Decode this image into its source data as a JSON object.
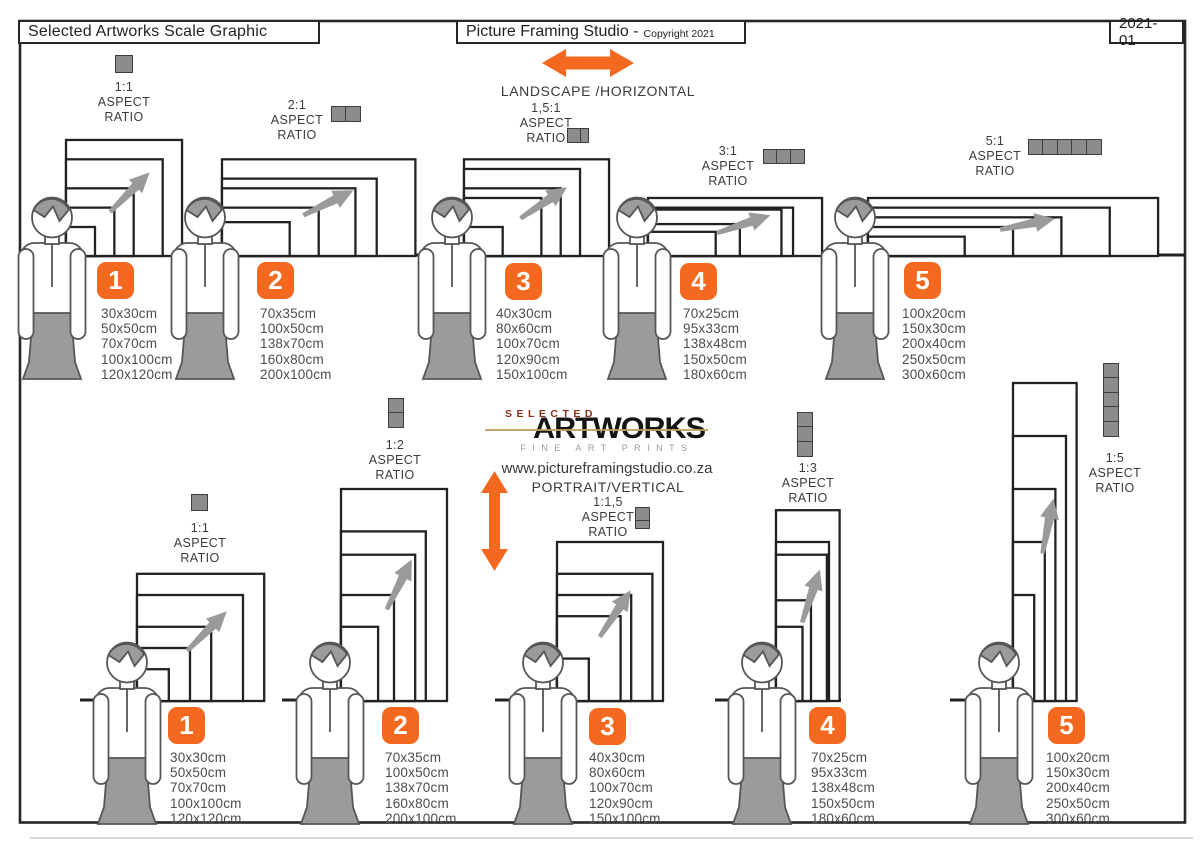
{
  "header": {
    "left_title": "Selected Artworks Scale Graphic",
    "center_title": "Picture Framing Studio -",
    "center_copyright": "Copyright 2021",
    "doc_code": "2021-01"
  },
  "orientation": {
    "landscape_label": "LANDSCAPE /HORIZONTAL",
    "portrait_label": "PORTRAIT/VERTICAL"
  },
  "logo": {
    "selected": "SELECTED",
    "artworks": "ARTWORKS",
    "tagline": "FINE ART PRINTS",
    "website": "www.pictureframingstudio.co.za"
  },
  "aspect_words": [
    "ASPECT",
    "RATIO"
  ],
  "rows": [
    {
      "name": "landscape",
      "groups": [
        {
          "number": "1",
          "ratio": "1:1",
          "icon": "aspect-ratio-1-1-icon",
          "sizes": [
            "30x30cm",
            "50x50cm",
            "70x70cm",
            "100x100cm",
            "120x120cm"
          ]
        },
        {
          "number": "2",
          "ratio": "2:1",
          "icon": "aspect-ratio-2-1-icon",
          "sizes": [
            "70x35cm",
            "100x50cm",
            "138x70cm",
            "160x80cm",
            "200x100cm"
          ]
        },
        {
          "number": "3",
          "ratio": "1,5:1",
          "icon": "aspect-ratio-1-5-1-icon",
          "sizes": [
            "40x30cm",
            "80x60cm",
            "100x70cm",
            "120x90cm",
            "150x100cm"
          ]
        },
        {
          "number": "4",
          "ratio": "3:1",
          "icon": "aspect-ratio-3-1-icon",
          "sizes": [
            "70x25cm",
            "95x33cm",
            "138x48cm",
            "150x50cm",
            "180x60cm"
          ]
        },
        {
          "number": "5",
          "ratio": "5:1",
          "icon": "aspect-ratio-5-1-icon",
          "sizes": [
            "100x20cm",
            "150x30cm",
            "200x40cm",
            "250x50cm",
            "300x60cm"
          ]
        }
      ]
    },
    {
      "name": "portrait",
      "groups": [
        {
          "number": "1",
          "ratio": "1:1",
          "icon": "aspect-ratio-1-1-icon",
          "sizes": [
            "30x30cm",
            "50x50cm",
            "70x70cm",
            "100x100cm",
            "120x120cm"
          ]
        },
        {
          "number": "2",
          "ratio": "1:2",
          "icon": "aspect-ratio-1-2-icon",
          "sizes": [
            "70x35cm",
            "100x50cm",
            "138x70cm",
            "160x80cm",
            "200x100cm"
          ]
        },
        {
          "number": "3",
          "ratio": "1:1,5",
          "icon": "aspect-ratio-1-1-5-icon",
          "sizes": [
            "40x30cm",
            "80x60cm",
            "100x70cm",
            "120x90cm",
            "150x100cm"
          ]
        },
        {
          "number": "4",
          "ratio": "1:3",
          "icon": "aspect-ratio-1-3-icon",
          "sizes": [
            "70x25cm",
            "95x33cm",
            "138x48cm",
            "150x50cm",
            "180x60cm"
          ]
        },
        {
          "number": "5",
          "ratio": "1:5",
          "icon": "aspect-ratio-1-5-icon",
          "sizes": [
            "100x20cm",
            "150x30cm",
            "200x40cm",
            "250x50cm",
            "300x60cm"
          ]
        }
      ]
    }
  ],
  "colors": {
    "accent_orange": "#F2691F",
    "frame_line": "#222222",
    "figure_gray": "#9B9B9B",
    "icon_gray": "#8C8C8C",
    "logo_red": "#8A3017",
    "logo_tan_line": "#BEA05F"
  }
}
